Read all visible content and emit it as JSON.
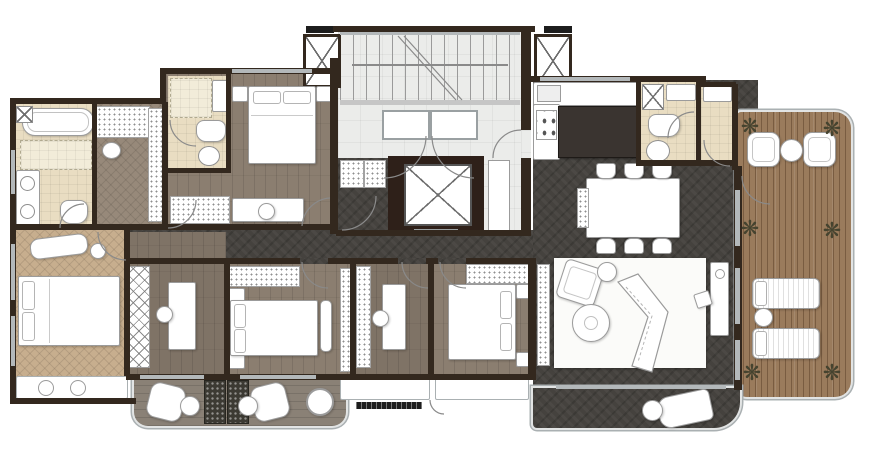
{
  "meta": {
    "kind": "architectural-floor-plan",
    "view": "top-down color rendered plan of a large apartment",
    "visible_text": "none"
  },
  "canvas": {
    "width": 878,
    "height": 462
  },
  "palette": {
    "bg": "#ffffff",
    "wall": "#33281e",
    "window": "#b3b8ba",
    "lobby": "#ebecea",
    "bedroom_a": "#8b7e70",
    "bedroom_b": "#7f7366",
    "master": "#c7ae8e",
    "bath": "#e9ddc2",
    "dressing": "#97897a",
    "dark": "#45423e",
    "deck": "#9a7b5c",
    "balcony": "#8a8176",
    "rug": "#fbfbf9",
    "island": "#3a3430",
    "furniture_line": "#9b9b9b",
    "plant": "#45432f",
    "ac": "#1d1d1d"
  },
  "icons": {
    "plant_glyph": "❋"
  },
  "core": {
    "stairs": "double-run public stair at top of central lobby",
    "elevator": "elevator shaft with X-marked cab",
    "shafts": "two X-marked service shafts flanking the stair",
    "entry_doors": "two lobby doors plus unit entry door on the right wall"
  },
  "rooms": [
    {
      "id": "stair-lobby",
      "name": "stair and elevator lobby",
      "floor": "light tile"
    },
    {
      "id": "master-bathroom",
      "name": "master bathroom",
      "floor": "cream tile",
      "fixtures": [
        "bathtub",
        "shower",
        "double-sink vanity",
        "toilet",
        "utility box"
      ]
    },
    {
      "id": "dressing-room",
      "name": "walk-in dressing room",
      "floor": "grey herringbone wood",
      "fixtures": [
        "hatched wardrobe",
        "tall closet",
        "stool"
      ]
    },
    {
      "id": "ensuite-bath",
      "name": "ensuite bathroom (upper-left bedroom)",
      "floor": "cream tile",
      "fixtures": [
        "shower",
        "wash cabinet",
        "toilet",
        "round sink"
      ]
    },
    {
      "id": "bedroom-upper-left",
      "name": "upper-left bedroom",
      "floor": "grey-brown plank wood",
      "fixtures": [
        "double bed",
        "2 nightstands",
        "desk with chair",
        "wardrobe"
      ]
    },
    {
      "id": "master-bedroom",
      "name": "master bedroom",
      "floor": "tan herringbone wood",
      "fixtures": [
        "king bed",
        "chaise lounge",
        "side table",
        "window seat"
      ]
    },
    {
      "id": "study",
      "name": "study / small bedroom",
      "floor": "plank wood",
      "fixtures": [
        "lattice wardrobe",
        "desk with chair"
      ]
    },
    {
      "id": "bedroom-center",
      "name": "center bedroom",
      "floor": "plank wood",
      "fixtures": [
        "double bed",
        "2 nightstands",
        "bench",
        "wardrobe",
        "closet"
      ]
    },
    {
      "id": "bedroom-small",
      "name": "small bedroom / study",
      "floor": "plank wood",
      "fixtures": [
        "wardrobe strip",
        "desk with chair"
      ]
    },
    {
      "id": "bedroom-right",
      "name": "right bedroom",
      "floor": "plank wood",
      "fixtures": [
        "double bed",
        "2 nightstands",
        "closet"
      ]
    },
    {
      "id": "corridor",
      "name": "internal corridor",
      "floor": "dark charcoal stone"
    },
    {
      "id": "kitchen",
      "name": "kitchen",
      "floor": "dark charcoal stone",
      "fixtures": [
        "L-shaped counter",
        "double sink",
        "4-burner cooktop",
        "dark island"
      ]
    },
    {
      "id": "powder-room",
      "name": "powder room / laundry",
      "floor": "cream tile",
      "fixtures": [
        "washer",
        "shelf",
        "toilet",
        "round sink"
      ]
    },
    {
      "id": "foyer",
      "name": "entry foyer",
      "floor": "cream tile",
      "fixtures": [
        "shoe cabinet"
      ]
    },
    {
      "id": "dining-room",
      "name": "dining area",
      "floor": "dark charcoal stone",
      "fixtures": [
        "rectangular table",
        "6 chairs",
        "bench",
        "sideboard"
      ]
    },
    {
      "id": "living-room",
      "name": "living room",
      "floor": "dark charcoal stone",
      "fixtures": [
        "area rug",
        "curved chevron sofa",
        "armchair",
        "ottoman",
        "round coffee table",
        "media console",
        "speaker"
      ]
    },
    {
      "id": "balcony-left",
      "name": "bottom-left balcony",
      "floor": "wood planks",
      "fixtures": [
        "2 armchairs",
        "2 round side tables",
        "2 planter boxes",
        "round pot"
      ]
    },
    {
      "id": "balcony-living",
      "name": "living-room balcony",
      "floor": "dark charcoal stone",
      "fixtures": [
        "lounge chair",
        "round side table"
      ]
    },
    {
      "id": "deck-terrace",
      "name": "timber deck terrace (right side)",
      "floor": "brown deck boards",
      "fixtures": [
        "2 armchairs",
        "round table",
        "2 sun loungers",
        "round side table",
        "6 potted plants"
      ]
    }
  ],
  "equipment": {
    "ac_pads": 3,
    "duct": "vertical service duct beside elevator"
  }
}
